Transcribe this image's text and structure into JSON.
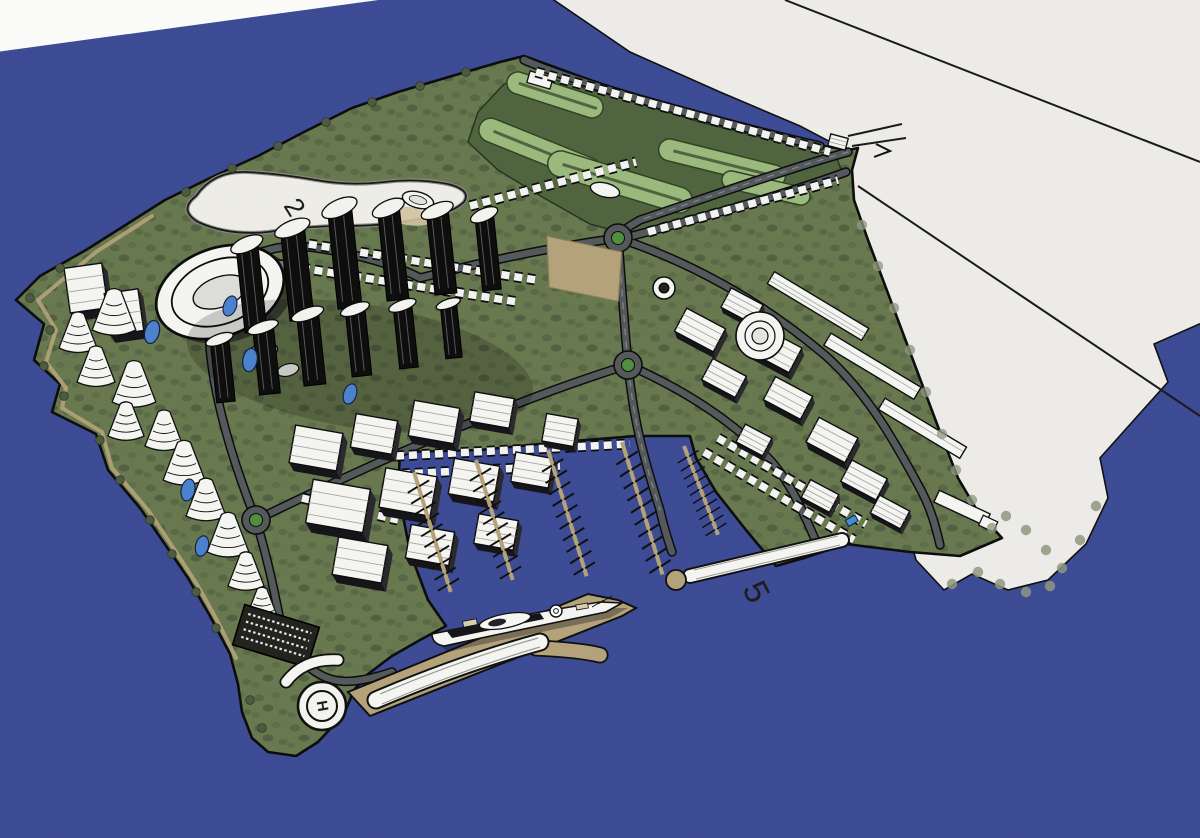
{
  "scene": {
    "description": "aerial-3d-masterplan-island-city-rendering",
    "labels": {
      "lake": "2",
      "pier": "5",
      "helipad": "H"
    },
    "colors": {
      "water": "#2c3d8b",
      "paper_corner": "#fafaf8",
      "mainland": "#ecebe8",
      "island_green": "#68784f",
      "golf_green": "#50653f",
      "fairway_green": "#9bb87d",
      "lake_white": "#f0efea",
      "road_gray": "#54595c",
      "sand_tan": "#b4a37a",
      "building_white": "#f4f4f1",
      "building_black": "#0e0e0e",
      "pond_blue": "#4c82cd",
      "roundabout_green": "#4f8f3d",
      "tree_green": "#4d5c41",
      "bush_gray": "#8f987f",
      "outline_ink": "#101010",
      "label_ink": "#1d1d1d"
    }
  }
}
